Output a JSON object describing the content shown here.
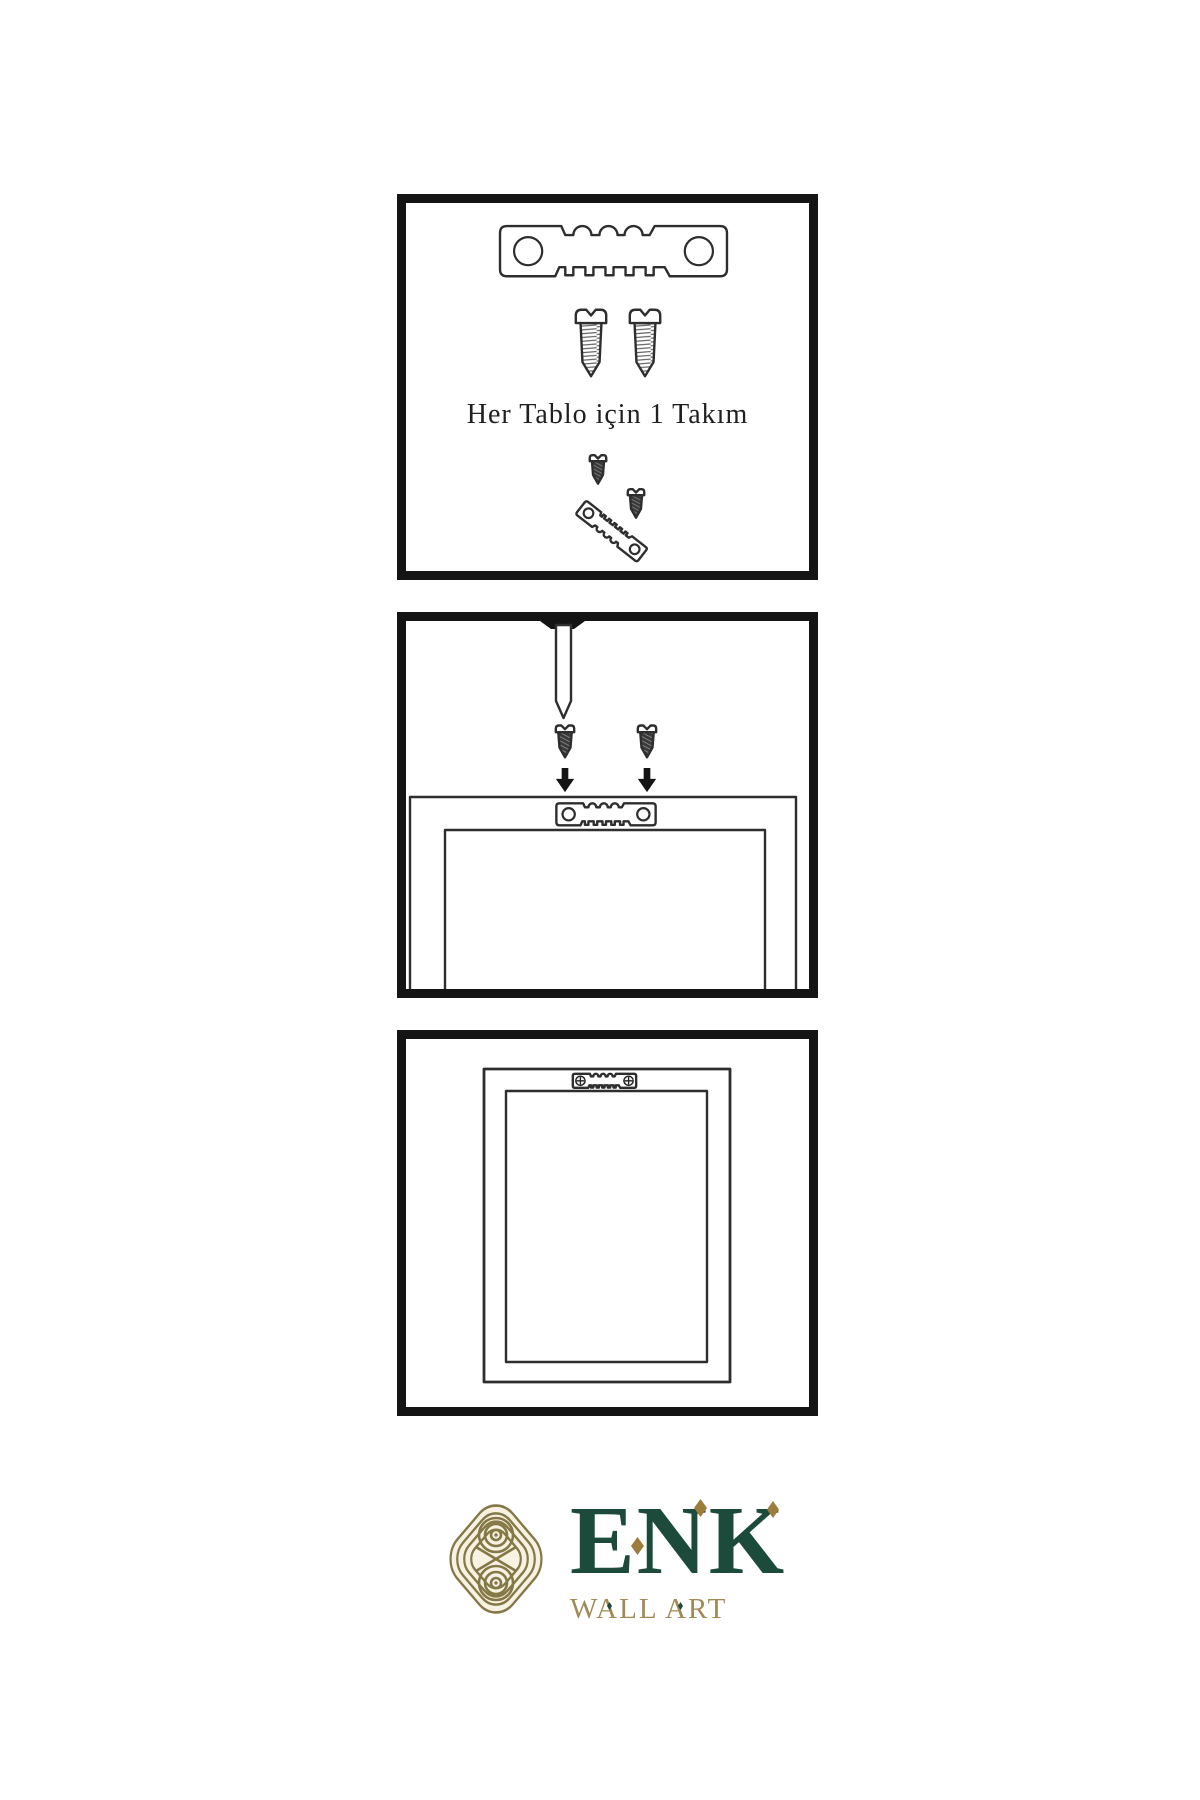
{
  "colors": {
    "page_bg": "#ffffff",
    "ink": "#2e2e2e",
    "panel_border": "#141414",
    "brand_green": "#1c4a3b",
    "diamond_gold": "#9d7d3c",
    "knot_gold": "#857847",
    "wallart_gold": "#a18a55",
    "caption_ink": "#1f1f1f",
    "screw_dark": "#3a3a3a"
  },
  "panels": {
    "kit": {
      "caption": "Her Tablo için 1 Takım",
      "contents": [
        "sawtooth-hanger",
        "two-screws",
        "screw-into-tilted-hanger"
      ]
    },
    "mount": {
      "contents": [
        "nail-through-wall",
        "two-screws-with-arrows",
        "frame-back-with-sawtooth-hanger"
      ]
    },
    "hung": {
      "contents": [
        "frame-back-with-mounted-hanger"
      ]
    }
  },
  "logo": {
    "name": "ENK",
    "subtitle": "WALL ART"
  },
  "icons": {
    "sawtooth-hanger-icon": "outlined metal strip, two round holes, castellated top, sawtooth bottom",
    "screw-light-icon": "outlined screw with horizontal thread hatching and pointed tip",
    "screw-dark-icon": "dark-filled screw with diagonal thread stripes and pointed tip",
    "arrow-down-icon": "solid black downward arrow",
    "nail-icon": "nail with black head driven through top border, outlined shaft, pointed tip",
    "frame-back-icon": "nested rectangles representing the back of a picture frame",
    "screw-head-icon": "circle with phillips cross",
    "knot-logo-icon": "interlaced celtic-style knot of concentric gold lines in rounded diamond"
  }
}
